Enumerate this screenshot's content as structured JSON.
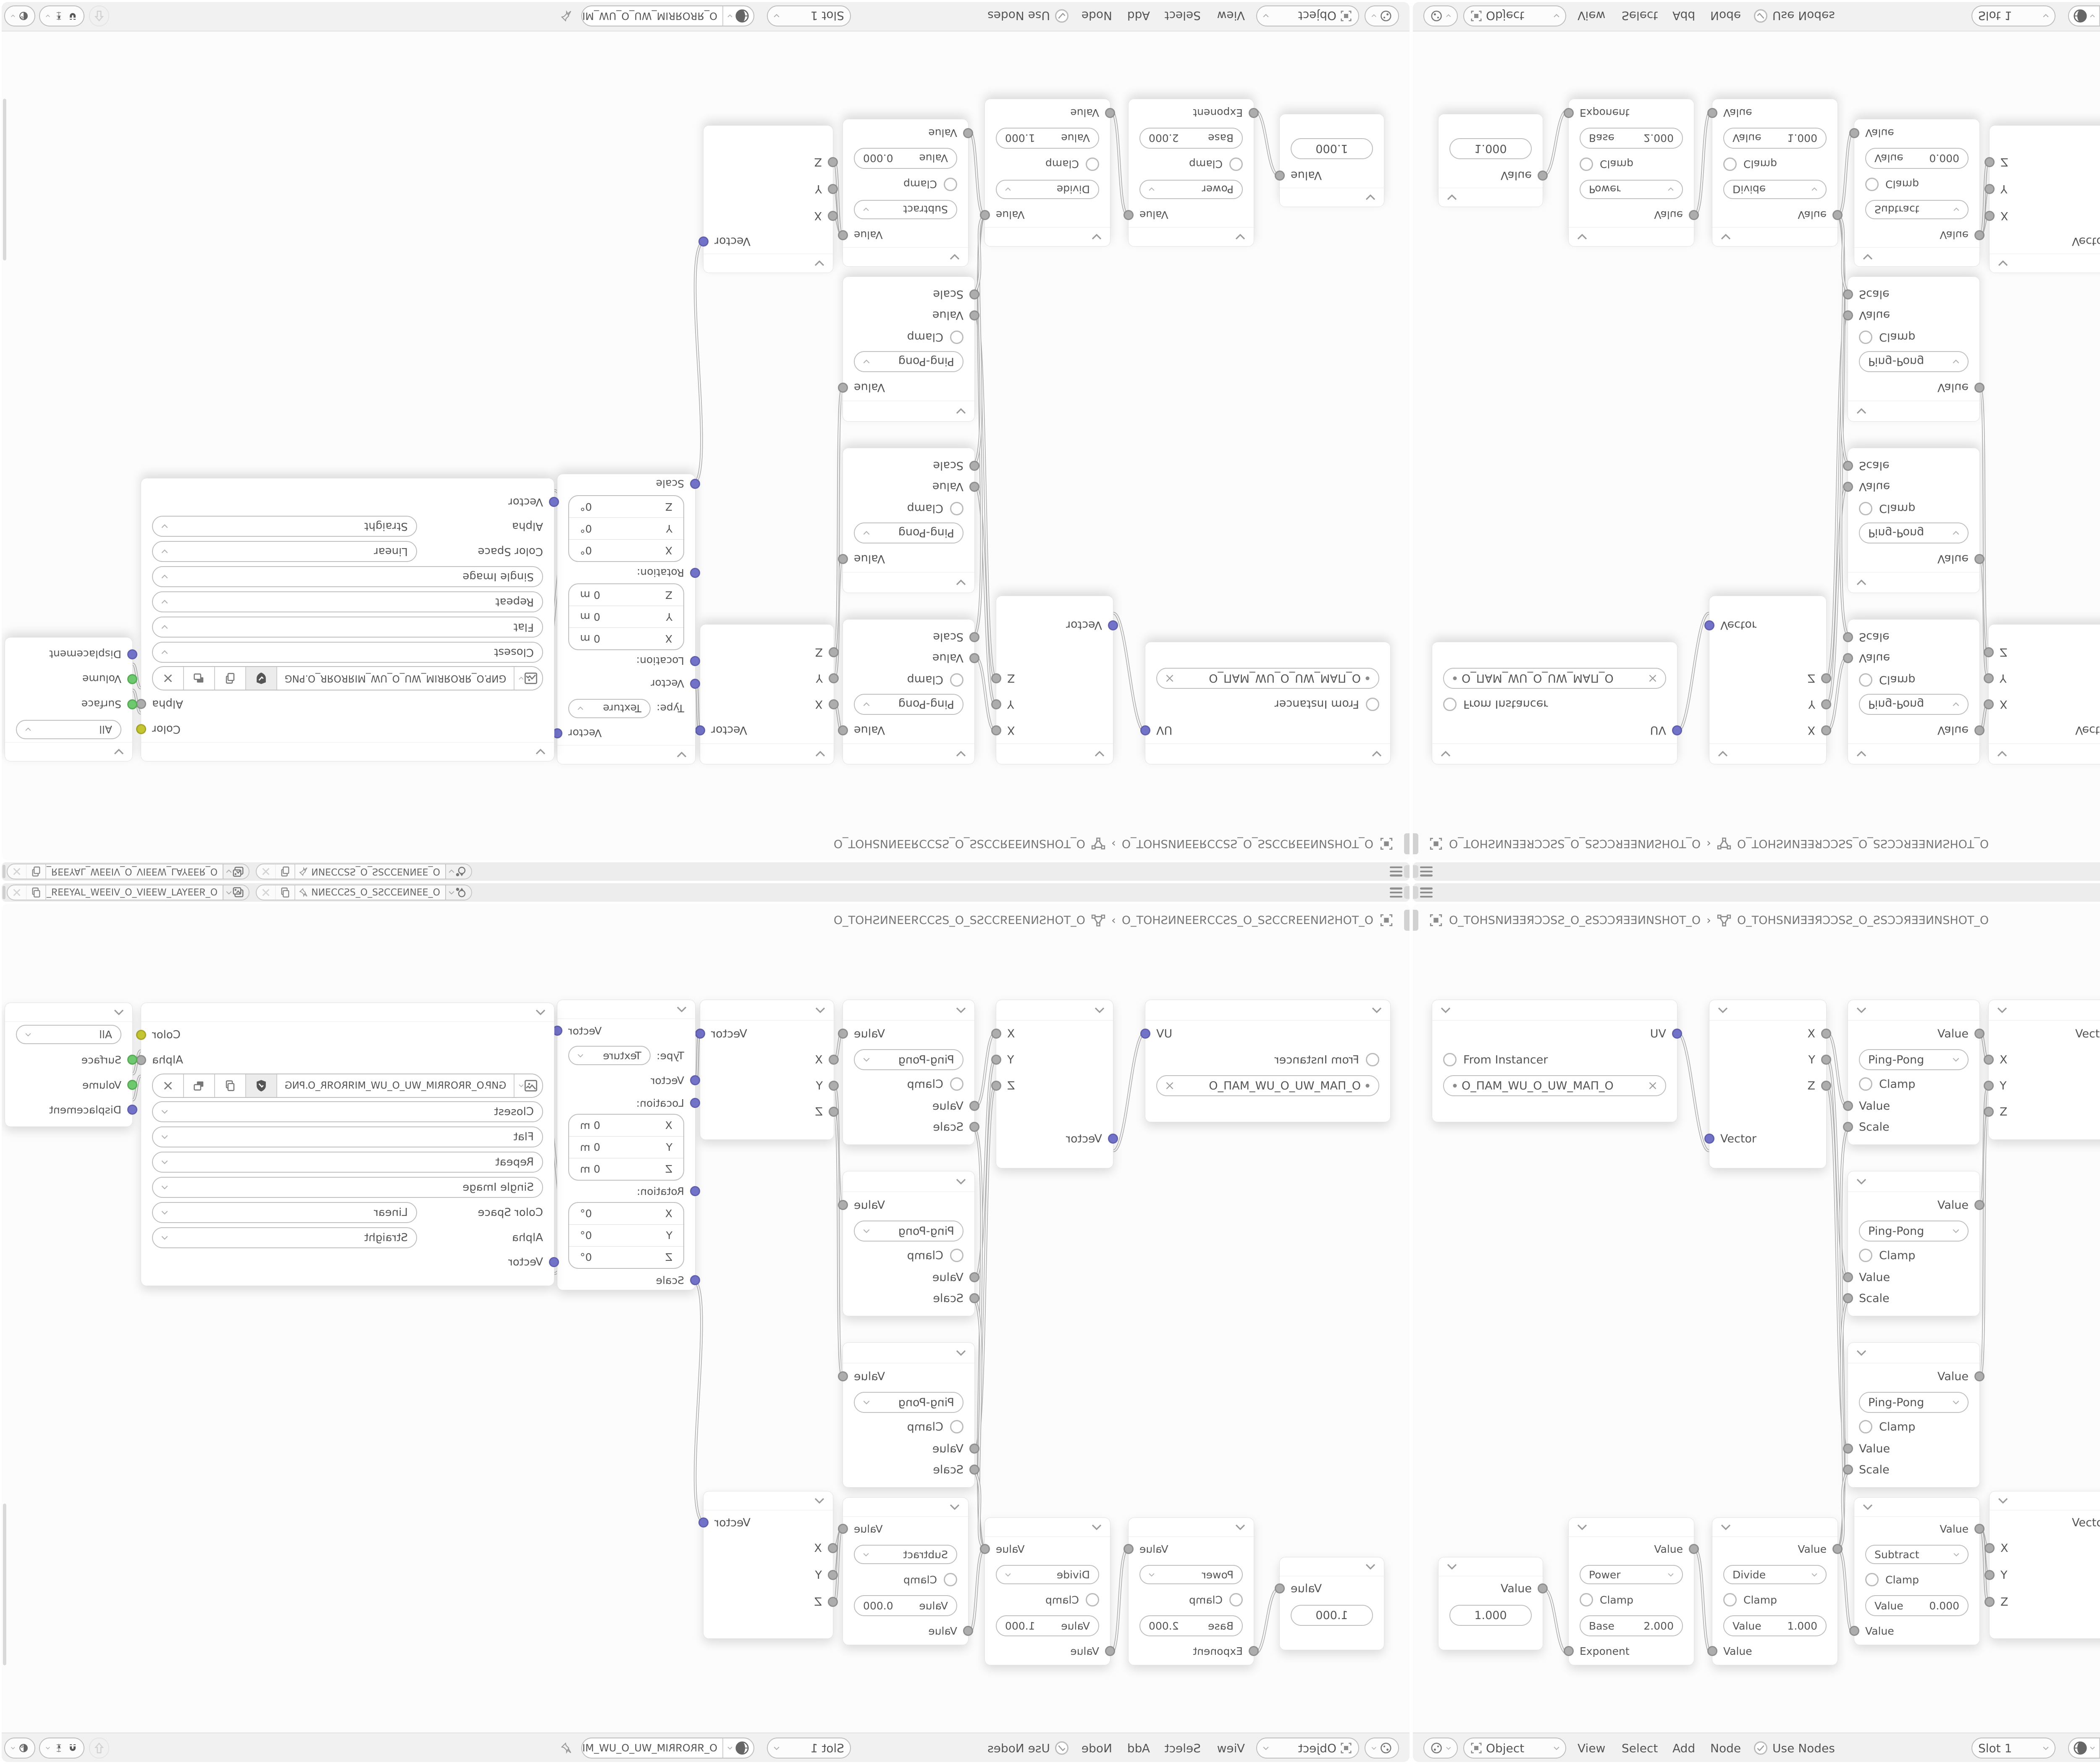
{
  "app": "blender-shader-editor-mirror-grid",
  "colors": {
    "canvas": "#fcfcfc",
    "bar": "#ededed",
    "node_bg": "#ffffff",
    "socket_vector": "#7272c9",
    "socket_value": "#adadad",
    "socket_color": "#c6c632",
    "socket_shader": "#6ec96e",
    "text": "#555555"
  },
  "topbar": {
    "scene_label": "O_ƎƎИNƎƆƆSƧ_O_ƧSƆƆƎNИ...",
    "view_layer_label": "O_ЯƎƎYA⅃_WƎƎIV_O_VIƎƎW_⅃AYƎƎЯ_O"
  },
  "breadcrumb": {
    "scene": "O_TOHSNИƎƎЯƆƆSƧ_O_ƧSƆƆЯƎƎИNSHOT_O",
    "separator": "›",
    "object": "O_TOHSNИƎƎЯƆƆSƧ_O_ƧSƆƆЯƎƎИNSHOT_O"
  },
  "header": {
    "mode": "Object",
    "menu_view": "View",
    "menu_select": "Select",
    "menu_add": "Add",
    "menu_node": "Node",
    "use_nodes": "Use Nodes",
    "slot": "Slot 1",
    "material": "O_ЯROЯRIM_WU_O_UW_MIЯROЯR_O"
  },
  "nodes": {
    "uv_map": {
      "output": "UV",
      "from_instancer": "From Instancer",
      "uv_name": "O_ПAM_WU_O_UW_MAП_O"
    },
    "separate_xyz": {
      "out_x": "X",
      "out_y": "Y",
      "out_z": "Z",
      "input": "Vector"
    },
    "math_pingpong": {
      "output": "Value",
      "operation": "Ping-Pong",
      "clamp": "Clamp",
      "in_value": "Value",
      "in_scale": "Scale"
    },
    "combine_xyz": {
      "output": "Vector",
      "in_x": "X",
      "in_y": "Y",
      "in_z": "Z"
    },
    "mapping": {
      "output": "Vector",
      "type_label": "Type:",
      "type_value": "Texture",
      "in_vector": "Vector",
      "location_label": "Location:",
      "loc_x_axis": "X",
      "loc_x": "0 m",
      "loc_y_axis": "Y",
      "loc_y": "0 m",
      "loc_z_axis": "Z",
      "loc_z": "0 m",
      "rotation_label": "Rotation:",
      "rot_x_axis": "X",
      "rot_x": "0°",
      "rot_y_axis": "Y",
      "rot_y": "0°",
      "rot_z_axis": "Z",
      "rot_z": "0°",
      "in_scale": "Scale"
    },
    "image_texture": {
      "out_color": "Color",
      "out_alpha": "Alpha",
      "filename": "GИP.O_ЯROЯRIM_WU_O_UW_MIЯROЯR_O.PNG",
      "interpolation": "Closest",
      "projection": "Flat",
      "extension": "Repeat",
      "source": "Single Image",
      "color_space_label": "Color Space",
      "color_space": "Linear",
      "alpha_label": "Alpha",
      "alpha_mode": "Straight",
      "in_vector": "Vector"
    },
    "material_output": {
      "target": "All",
      "in_surface": "Surface",
      "in_volume": "Volume",
      "in_displacement": "Displacement"
    },
    "value": {
      "output": "Value",
      "value": "1.000"
    },
    "math_power": {
      "output": "Value",
      "operation": "Power",
      "clamp": "Clamp",
      "field_label": "Base",
      "field_value": "2.000",
      "input": "Exponent"
    },
    "math_divide": {
      "output": "Value",
      "operation": "Divide",
      "clamp": "Clamp",
      "field_label": "Value",
      "field_value": "1.000",
      "input": "Value"
    },
    "math_subtract": {
      "output": "Value",
      "operation": "Subtract",
      "clamp": "Clamp",
      "field_label": "Value",
      "field_value": "0.000",
      "input": "Value"
    }
  }
}
